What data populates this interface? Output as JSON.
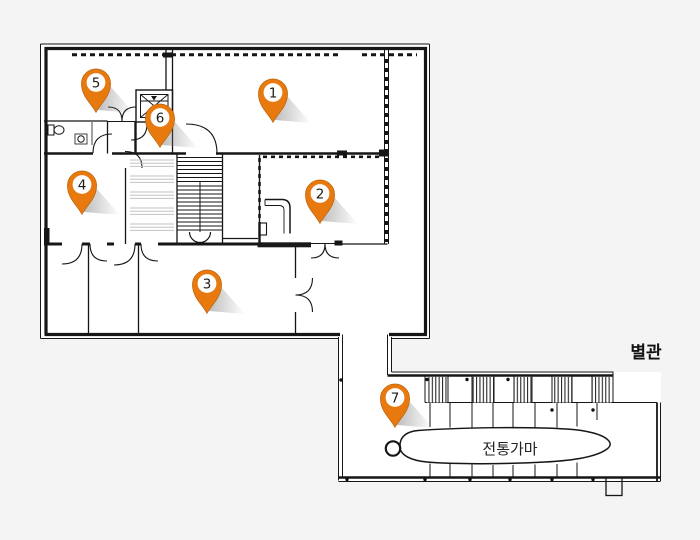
{
  "colors": {
    "background": "#f4f4f4",
    "paper": "#ffffff",
    "wall": "#161616",
    "pin_fill": "#e8790f",
    "pin_edge": "#b35c05",
    "pin_number": "#1b1b1b",
    "pin_shadow": "#777777"
  },
  "labels": {
    "annex": "별관",
    "kiln": "전통가마"
  },
  "pins": [
    {
      "label": "1",
      "x": 273,
      "y": 94
    },
    {
      "label": "2",
      "x": 320,
      "y": 195
    },
    {
      "label": "3",
      "x": 207,
      "y": 285
    },
    {
      "label": "4",
      "x": 82,
      "y": 186
    },
    {
      "label": "5",
      "x": 96,
      "y": 84
    },
    {
      "label": "6",
      "x": 160,
      "y": 119
    },
    {
      "label": "7",
      "x": 395,
      "y": 399
    }
  ]
}
